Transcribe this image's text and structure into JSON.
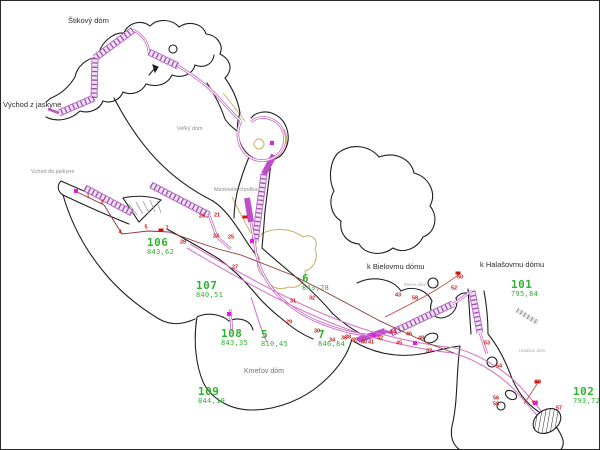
{
  "map": {
    "colors": {
      "background": "#ffffff",
      "outline": "#1f1f1f",
      "corridor_edge": "#b565c4",
      "corridor_fill": "#f0e2f4",
      "corridor_rung": "#9b4fae",
      "corridor_solid": "#bf4ecb",
      "survey_pink": "#d678c8",
      "survey_darkred": "#8b3232",
      "survey_redline": "#c24040",
      "station_green": "#2fb32f",
      "point_red": "#cc1414",
      "marker_magenta": "#e21ce2",
      "marker_red": "#cc1414",
      "sediment_tan": "#c8b068",
      "hatch_gray": "#9a9a9a"
    },
    "labels": [
      {
        "text": "Štikový dóm",
        "x": 67,
        "y": 16,
        "style": "title"
      },
      {
        "text": "Východ z jaskyne",
        "x": 2,
        "y": 100,
        "style": "title"
      },
      {
        "text": "Vchod do jaskyne",
        "x": 30,
        "y": 169,
        "style": "gray"
      },
      {
        "text": "Veľký dóm",
        "x": 176,
        "y": 126,
        "style": "gray"
      },
      {
        "text": "Medvedia chodba",
        "x": 213,
        "y": 187,
        "style": "gray"
      },
      {
        "text": "k Bielovmu dómu",
        "x": 366,
        "y": 262,
        "style": "title"
      },
      {
        "text": "k Halašovmu dómu",
        "x": 479,
        "y": 260,
        "style": "title"
      },
      {
        "text": "Bielov dóm",
        "x": 403,
        "y": 282,
        "style": "tiny"
      },
      {
        "text": "Halašov dóm",
        "x": 518,
        "y": 348,
        "style": "tiny"
      },
      {
        "text": "Kmeťov dóm",
        "x": 243,
        "y": 367,
        "style": "room"
      }
    ],
    "stations": [
      {
        "id": "106",
        "elev": "843,62",
        "x": 146,
        "y": 236
      },
      {
        "id": "107",
        "elev": "840,51",
        "x": 195,
        "y": 279
      },
      {
        "id": "108",
        "elev": "843,35",
        "x": 220,
        "y": 327
      },
      {
        "id": "109",
        "elev": "844,19",
        "x": 197,
        "y": 385
      },
      {
        "id": "5",
        "elev": "810,45",
        "x": 260,
        "y": 328
      },
      {
        "id": "6",
        "elev": "843,28",
        "x": 301,
        "y": 272
      },
      {
        "id": "7",
        "elev": "846,84",
        "x": 317,
        "y": 328
      },
      {
        "id": "101",
        "elev": "795,84",
        "x": 510,
        "y": 278
      },
      {
        "id": "102",
        "elev": "793,72",
        "x": 572,
        "y": 385
      }
    ],
    "points": [
      {
        "n": "1",
        "x": 87,
        "y": 196
      },
      {
        "n": "3",
        "x": 101,
        "y": 202
      },
      {
        "n": "4",
        "x": 119,
        "y": 232
      },
      {
        "n": "5",
        "x": 145,
        "y": 227
      },
      {
        "n": "7",
        "x": 166,
        "y": 228
      },
      {
        "n": "21",
        "x": 216,
        "y": 215
      },
      {
        "n": "24",
        "x": 215,
        "y": 236
      },
      {
        "n": "25",
        "x": 230,
        "y": 237
      },
      {
        "n": "26",
        "x": 201,
        "y": 216
      },
      {
        "n": "27",
        "x": 234,
        "y": 267
      },
      {
        "n": "28",
        "x": 182,
        "y": 242
      },
      {
        "n": "29",
        "x": 288,
        "y": 322
      },
      {
        "n": "30",
        "x": 316,
        "y": 331
      },
      {
        "n": "31",
        "x": 292,
        "y": 301
      },
      {
        "n": "32",
        "x": 311,
        "y": 298
      },
      {
        "n": "34",
        "x": 331,
        "y": 340
      },
      {
        "n": "36",
        "x": 343,
        "y": 338
      },
      {
        "n": "37",
        "x": 428,
        "y": 351
      },
      {
        "n": "38",
        "x": 347,
        "y": 337
      },
      {
        "n": "39",
        "x": 354,
        "y": 340
      },
      {
        "n": "40",
        "x": 363,
        "y": 342
      },
      {
        "n": "41",
        "x": 370,
        "y": 342
      },
      {
        "n": "42",
        "x": 379,
        "y": 338
      },
      {
        "n": "43",
        "x": 397,
        "y": 295
      },
      {
        "n": "58",
        "x": 414,
        "y": 298
      },
      {
        "n": "44",
        "x": 392,
        "y": 332
      },
      {
        "n": "45",
        "x": 398,
        "y": 343
      },
      {
        "n": "46",
        "x": 408,
        "y": 334
      },
      {
        "n": "48",
        "x": 420,
        "y": 338
      },
      {
        "n": "50",
        "x": 459,
        "y": 277
      },
      {
        "n": "52",
        "x": 453,
        "y": 288
      },
      {
        "n": "53",
        "x": 486,
        "y": 343
      },
      {
        "n": "54",
        "x": 498,
        "y": 366
      },
      {
        "n": "55",
        "x": 495,
        "y": 404
      },
      {
        "n": "56",
        "x": 495,
        "y": 398
      },
      {
        "n": "57",
        "x": 558,
        "y": 408
      },
      {
        "n": "58",
        "x": 534,
        "y": 403
      },
      {
        "n": "59",
        "x": 537,
        "y": 382
      }
    ],
    "markers": {
      "magenta": [
        {
          "x": 75,
          "y": 190
        },
        {
          "x": 271,
          "y": 142
        },
        {
          "x": 251,
          "y": 240
        },
        {
          "x": 228,
          "y": 313
        },
        {
          "x": 373,
          "y": 334
        },
        {
          "x": 414,
          "y": 342
        },
        {
          "x": 534,
          "y": 402
        }
      ],
      "red": [
        {
          "x": 160,
          "y": 229
        },
        {
          "x": 244,
          "y": 216
        },
        {
          "x": 457,
          "y": 272
        },
        {
          "x": 536,
          "y": 381
        }
      ]
    }
  }
}
